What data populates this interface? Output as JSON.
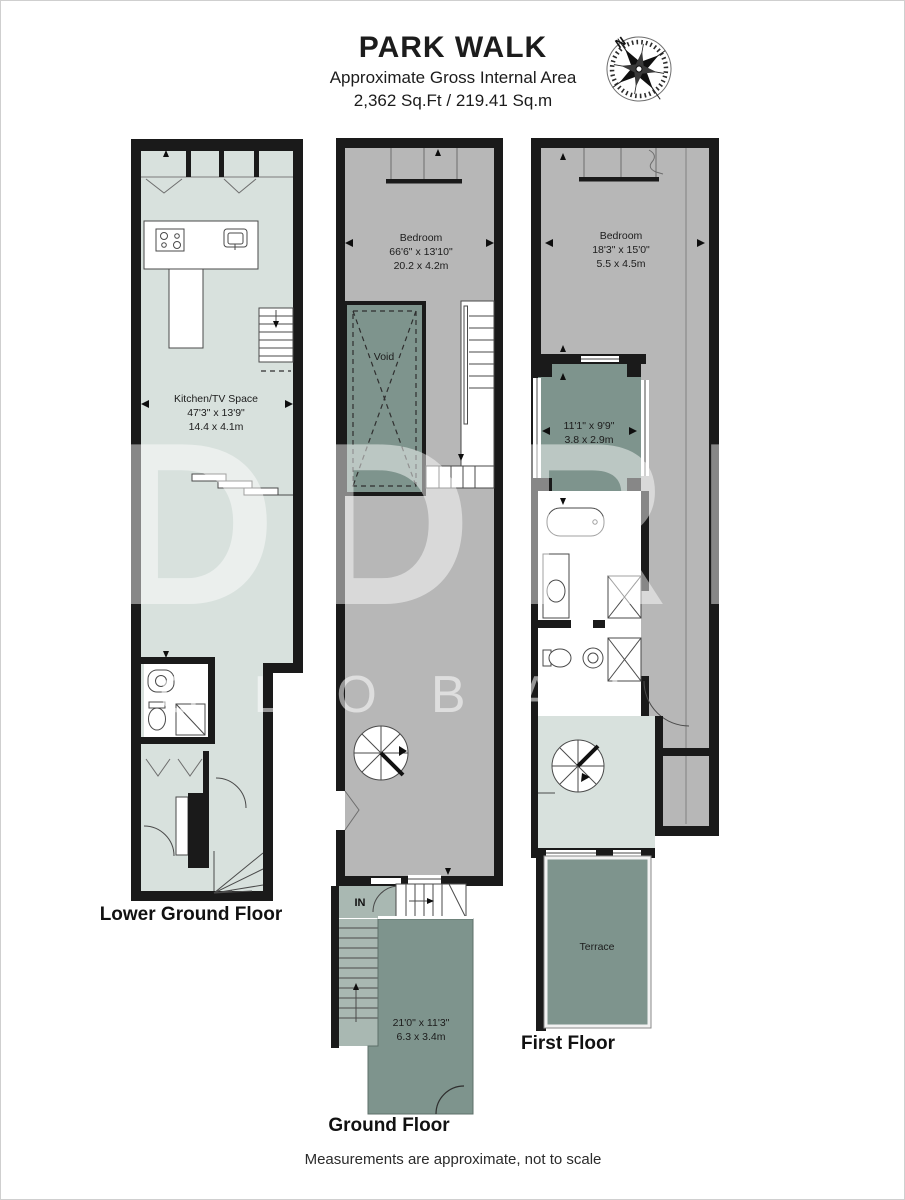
{
  "header": {
    "title": "PARK WALK",
    "subtitle1": "Approximate Gross Internal Area",
    "subtitle2": "2,362 Sq.Ft / 219.41 Sq.m"
  },
  "compass": {
    "north_label": "N"
  },
  "floors": {
    "lower_ground": {
      "label": "Lower Ground Floor",
      "room_name": "Kitchen/TV Space",
      "room_imperial": "47'3\" x 13'9\"",
      "room_metric": "14.4 x 4.1m"
    },
    "ground": {
      "label": "Ground Floor",
      "bedroom_name": "Bedroom",
      "bedroom_imperial": "66'6\" x 13'10\"",
      "bedroom_metric": "20.2 x 4.2m",
      "void_label": "Void",
      "in_label": "IN",
      "front_imperial": "21'0\" x 11'3\"",
      "front_metric": "6.3 x 3.4m"
    },
    "first": {
      "label": "First Floor",
      "bedroom_name": "Bedroom",
      "bedroom_imperial": "18'3\" x 15'0\"",
      "bedroom_metric": "5.5 x 4.5m",
      "dressing_imperial": "11'1\" x 9'9\"",
      "dressing_metric": "3.8 x 2.9m",
      "terrace_label": "Terrace"
    }
  },
  "watermark": {
    "line1": "DDRE",
    "line2": "GLOBAL"
  },
  "footer": {
    "note": "Measurements are approximate, not to scale"
  },
  "palette": {
    "wall": "#1a1a1a",
    "pale": "#d8e1dd",
    "grey": "#b7b7b7",
    "sage": "#7e948d",
    "sageMid": "#a9b8b2",
    "text": "#1c1c1c",
    "line": "#4a4a4a"
  }
}
